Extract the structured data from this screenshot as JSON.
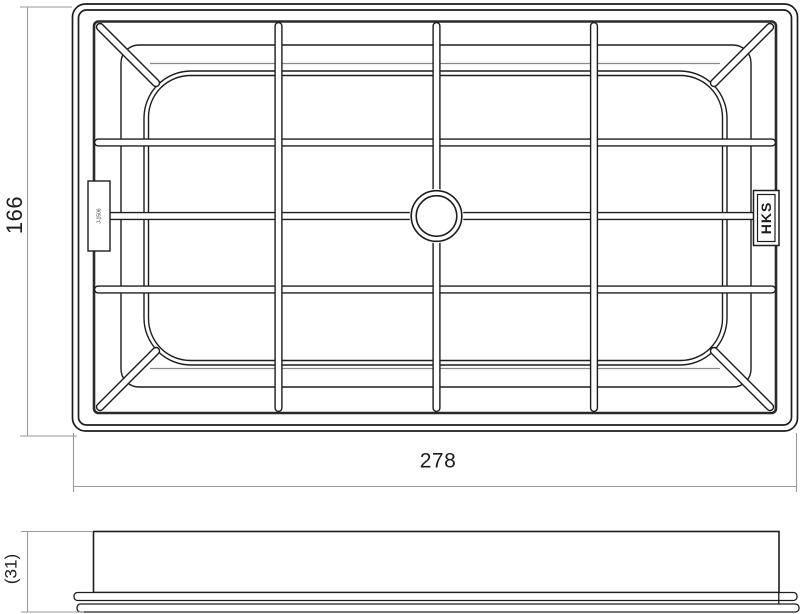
{
  "page": {
    "background": "#ffffff"
  },
  "drawing": {
    "subject": "Panel air filter engineering drawing, top view and side profile",
    "colors": {
      "line": "#1d1d1d",
      "wall_line": "#2a2a2a",
      "soft_line": "#8a8a8a",
      "dimension_line": "#9a9a9a",
      "background": "#ffffff"
    },
    "top_view": {
      "brand_label": "HKS",
      "tab_marking": "J-1506",
      "width_dim": "278",
      "height_dim": "166"
    },
    "side_view": {
      "thickness_dim": "(31)"
    }
  }
}
